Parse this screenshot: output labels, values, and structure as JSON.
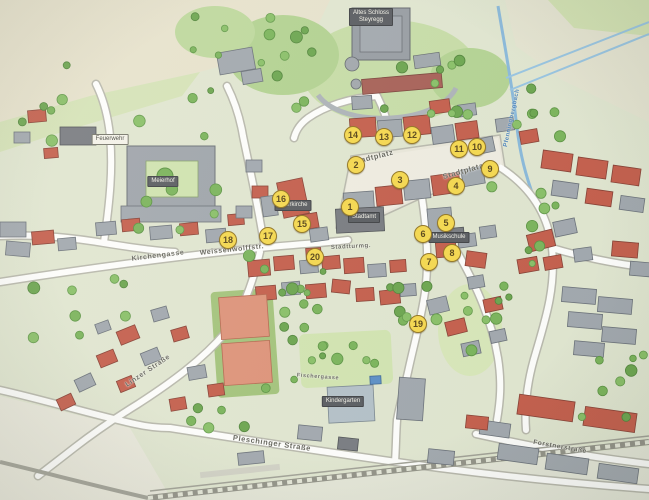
{
  "map": {
    "kind": "illustrated-town-map-photo",
    "town_hint": "Steyregg",
    "marker_style": {
      "fill": "#f6d641",
      "border": "#8a6a10",
      "text": "#4a3505"
    },
    "water_color": "#7fb3da",
    "road_color": "#ffffff",
    "roof_red": "#c0503e",
    "roof_gray": "#9aa1aa"
  },
  "markers": [
    {
      "n": "1",
      "x": 350,
      "y": 207
    },
    {
      "n": "2",
      "x": 356,
      "y": 165
    },
    {
      "n": "3",
      "x": 400,
      "y": 180
    },
    {
      "n": "4",
      "x": 456,
      "y": 186
    },
    {
      "n": "5",
      "x": 446,
      "y": 223
    },
    {
      "n": "6",
      "x": 423,
      "y": 234
    },
    {
      "n": "7",
      "x": 429,
      "y": 262
    },
    {
      "n": "8",
      "x": 452,
      "y": 253
    },
    {
      "n": "9",
      "x": 490,
      "y": 169
    },
    {
      "n": "10",
      "x": 477,
      "y": 147
    },
    {
      "n": "11",
      "x": 459,
      "y": 149
    },
    {
      "n": "12",
      "x": 412,
      "y": 135
    },
    {
      "n": "13",
      "x": 384,
      "y": 137
    },
    {
      "n": "14",
      "x": 353,
      "y": 135
    },
    {
      "n": "15",
      "x": 302,
      "y": 224
    },
    {
      "n": "16",
      "x": 281,
      "y": 199
    },
    {
      "n": "17",
      "x": 268,
      "y": 236
    },
    {
      "n": "18",
      "x": 228,
      "y": 240
    },
    {
      "n": "19",
      "x": 418,
      "y": 324
    },
    {
      "n": "20",
      "x": 315,
      "y": 257
    }
  ],
  "street_labels": [
    {
      "text": "Kirchengasse",
      "x": 158,
      "y": 256,
      "rot": -7,
      "size": 7
    },
    {
      "text": "Weissenwolffstr.",
      "x": 232,
      "y": 250,
      "rot": -6,
      "size": 7
    },
    {
      "text": "Stadtturmg.",
      "x": 351,
      "y": 247,
      "rot": -3,
      "size": 6
    },
    {
      "text": "Stadtplatz",
      "x": 373,
      "y": 157,
      "rot": -14,
      "size": 7.5
    },
    {
      "text": "Stadtplatz",
      "x": 463,
      "y": 171,
      "rot": -16,
      "size": 7.5
    },
    {
      "text": "Linzer Straße",
      "x": 148,
      "y": 371,
      "rot": -34,
      "size": 7
    },
    {
      "text": "Pleschinger Straße",
      "x": 272,
      "y": 443,
      "rot": 8,
      "size": 7.5
    },
    {
      "text": "Forstnerstraße",
      "x": 560,
      "y": 447,
      "rot": 10,
      "size": 6.5
    },
    {
      "text": "Fischergasse",
      "x": 318,
      "y": 377,
      "rot": 4,
      "size": 5.5
    }
  ],
  "water_labels": [
    {
      "text": "Pfenningbergbach",
      "x": 512,
      "y": 118,
      "rot": -78,
      "size": 6
    }
  ],
  "poi_labels": [
    {
      "text": "Altes Schloss",
      "text2": "Steyregg",
      "x": 371,
      "y": 8,
      "style": "dark"
    },
    {
      "text": "Stadtamt",
      "text2": "",
      "x": 364,
      "y": 212,
      "style": "dark"
    },
    {
      "text": "Pfarrkirche",
      "text2": "",
      "x": 293,
      "y": 200,
      "style": "dark"
    },
    {
      "text": "Meierhof",
      "text2": "",
      "x": 163,
      "y": 176,
      "style": "dark"
    },
    {
      "text": "Musikschule",
      "text2": "",
      "x": 449,
      "y": 232,
      "style": "dark"
    },
    {
      "text": "Kindergarten",
      "text2": "",
      "x": 343,
      "y": 396,
      "style": "dark"
    },
    {
      "text": "Feuerwehr",
      "text2": "",
      "x": 110,
      "y": 134,
      "style": "light"
    }
  ]
}
